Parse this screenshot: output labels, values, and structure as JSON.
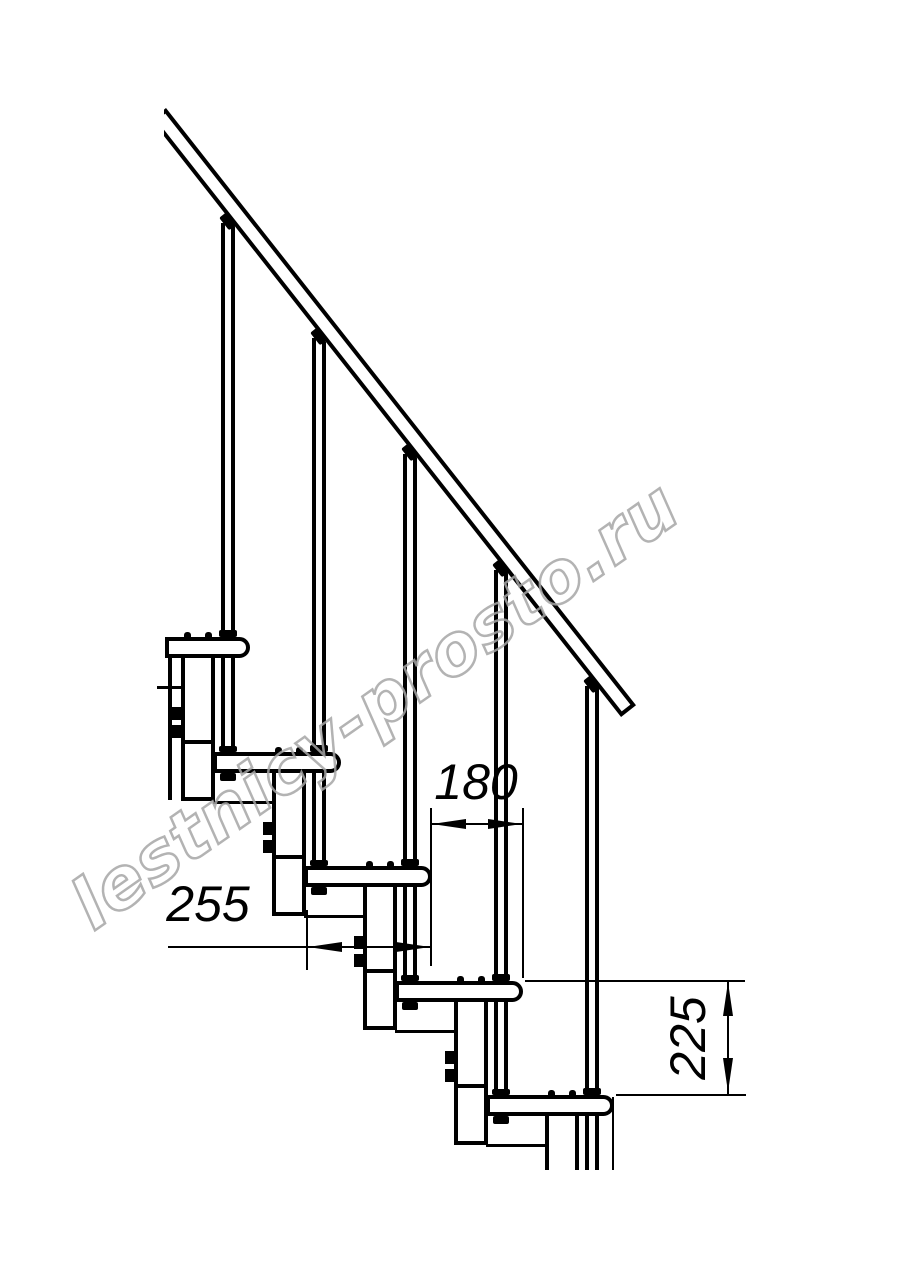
{
  "watermark": {
    "text": "lestnicy-prosto.ru"
  },
  "dimensions": {
    "tread_run": {
      "label": "180"
    },
    "tread_depth": {
      "label": "255"
    },
    "step_height": {
      "label": "225"
    }
  },
  "structure": {
    "step_count": 5,
    "baluster_count": 5
  },
  "colors": {
    "line": "#000000",
    "background": "#ffffff",
    "watermark": "#a6a6a6"
  }
}
